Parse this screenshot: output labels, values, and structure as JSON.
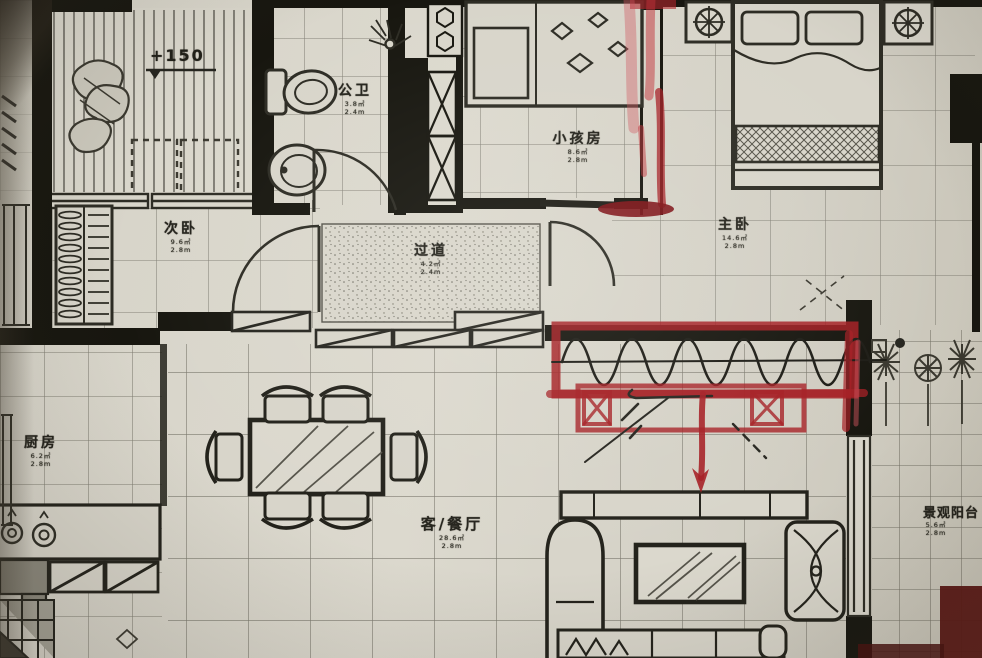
{
  "plan": {
    "elevation_label": "+150",
    "rooms": [
      {
        "name": "公卫",
        "line1": "3.8㎡",
        "line2": "2.4m"
      },
      {
        "name": "小孩房",
        "line1": "8.6㎡",
        "line2": "2.8m"
      },
      {
        "name": "次卧",
        "line1": "9.6㎡",
        "line2": "2.8m"
      },
      {
        "name": "主卧",
        "line1": "14.6㎡",
        "line2": "2.8m"
      },
      {
        "name": "过道",
        "line1": "4.2㎡",
        "line2": "2.4m"
      },
      {
        "name": "客/餐厅",
        "line1": "28.6㎡",
        "line2": "2.8m"
      },
      {
        "name": "厨房",
        "line1": "6.2㎡",
        "line2": "2.8m"
      },
      {
        "name": "景观阳台",
        "line1": "5.6㎡",
        "line2": "2.8m"
      }
    ],
    "colors": {
      "paper": "#d6d3c8",
      "ink": "#26251f",
      "wall": "#17160f",
      "marker_red": "#a51e23"
    },
    "annotations": {
      "items": [
        {
          "name": "red-marker-vertical-strokes"
        },
        {
          "name": "red-highlight-box-with-wavy-line"
        },
        {
          "name": "red-sideboard-sketch"
        },
        {
          "name": "red-down-arrow"
        },
        {
          "name": "red-wall-edge-marks"
        }
      ]
    }
  }
}
